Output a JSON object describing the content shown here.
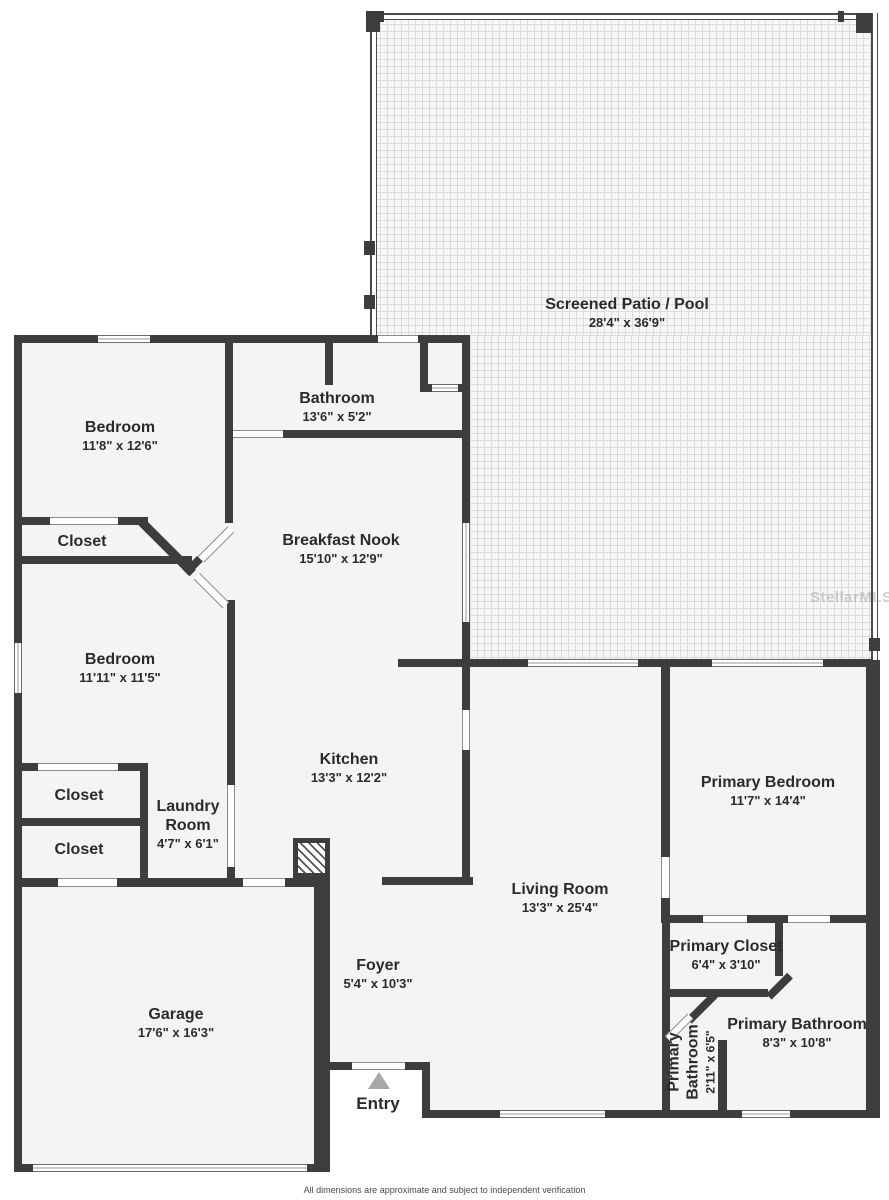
{
  "rooms": {
    "screened_patio": {
      "name": "Screened Patio / Pool",
      "dims": "28'4\" x 36'9\""
    },
    "bedroom1": {
      "name": "Bedroom",
      "dims": "11'8\" x 12'6\""
    },
    "bathroom": {
      "name": "Bathroom",
      "dims": "13'6\" x 5'2\""
    },
    "breakfast_nook": {
      "name": "Breakfast Nook",
      "dims": "15'10\" x 12'9\""
    },
    "closet1": {
      "name": "Closet"
    },
    "bedroom2": {
      "name": "Bedroom",
      "dims": "11'11\" x 11'5\""
    },
    "closet2": {
      "name": "Closet"
    },
    "closet3": {
      "name": "Closet"
    },
    "laundry": {
      "line1": "Laundry",
      "line2": "Room",
      "dims": "4'7\" x 6'1\""
    },
    "kitchen": {
      "name": "Kitchen",
      "dims": "13'3\" x 12'2\""
    },
    "living": {
      "name": "Living Room",
      "dims": "13'3\" x 25'4\""
    },
    "primary_bedroom": {
      "name": "Primary Bedroom",
      "dims": "11'7\" x 14'4\""
    },
    "primary_closet": {
      "name": "Primary Closet",
      "dims": "6'4\" x 3'10\""
    },
    "primary_bathroom": {
      "name": "Primary Bathroom",
      "dims": "8'3\" x 10'8\""
    },
    "primary_bathroom_wc": {
      "line1": "Primary",
      "line2": "Bathroom",
      "dims": "2'11\" x 6'5\""
    },
    "garage": {
      "name": "Garage",
      "dims": "17'6\" x 16'3\""
    },
    "foyer": {
      "name": "Foyer",
      "dims": "5'4\" x 10'3\""
    },
    "entry": {
      "name": "Entry"
    }
  },
  "watermark": "StellarMLS",
  "footer": {
    "disclaimer": "All dimensions are approximate and subject to independent verification"
  },
  "colors": {
    "wall": "#3d3d3d",
    "room_fill": "#f4f4f4",
    "entry_arrow": "#a8a8a8",
    "patio_tile_line": "#dcdcdc"
  }
}
